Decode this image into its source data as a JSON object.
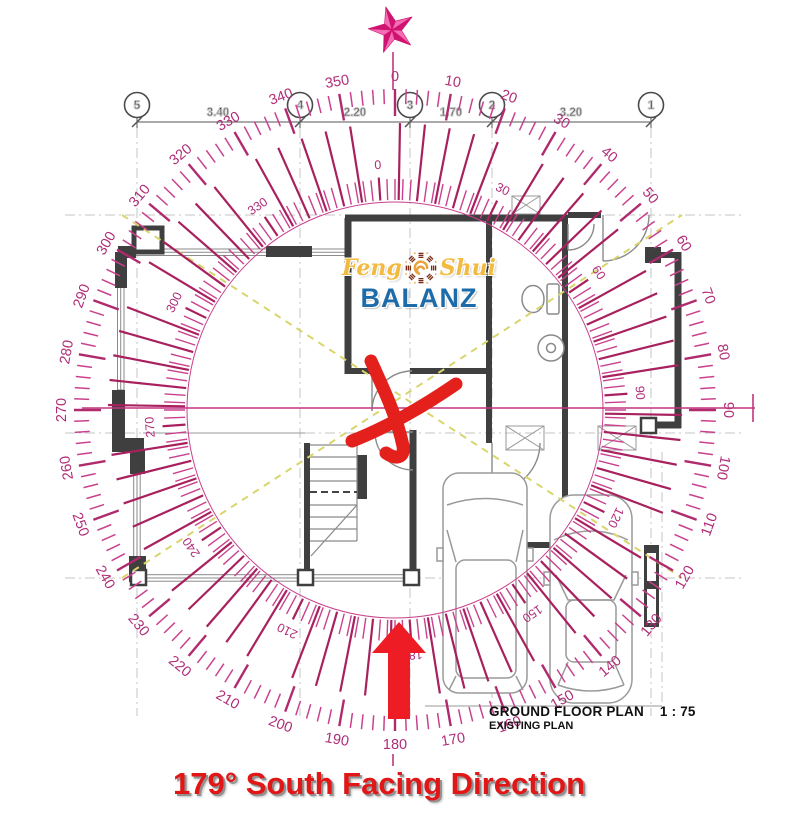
{
  "title": {
    "text": "179° South Facing Direction",
    "color": "#e11717"
  },
  "plan_label": {
    "name": "GROUND FLOOR PLAN",
    "scale": "1 : 75",
    "sub": "EXISTING PLAN"
  },
  "logo": {
    "script_left": "Feng",
    "script_right": "Shui",
    "main": "BALANZ",
    "script_color": "#f2ba3e",
    "main_color": "#1d6ca9",
    "bagua_icon": "bagua-icon"
  },
  "grid": {
    "bubble_y": 105,
    "dim_y": 116,
    "bubbles": [
      {
        "label": "5",
        "x": 137
      },
      {
        "label": "4",
        "x": 300
      },
      {
        "label": "3",
        "x": 410
      },
      {
        "label": "2",
        "x": 492
      },
      {
        "label": "1",
        "x": 651
      }
    ],
    "dims": [
      {
        "label": "3.40",
        "x": 218
      },
      {
        "label": "2.20",
        "x": 355
      },
      {
        "label": "1.70",
        "x": 451
      },
      {
        "label": "3.20",
        "x": 571
      }
    ]
  },
  "compass": {
    "center_x": 395,
    "center_y": 410,
    "inner_offset_deg": -4,
    "outer_labels": [
      0,
      10,
      20,
      30,
      40,
      50,
      60,
      70,
      80,
      90,
      100,
      110,
      120,
      130,
      140,
      150,
      160,
      170,
      180,
      190,
      200,
      210,
      220,
      230,
      240,
      250,
      260,
      270,
      280,
      290,
      300,
      310,
      320,
      330,
      340,
      350
    ],
    "inner_labels": [
      0,
      30,
      60,
      90,
      120,
      150,
      180,
      210,
      240,
      270,
      300,
      330
    ],
    "colors": {
      "tick_minor": "#c9418e",
      "tick_major": "#b02a6e",
      "tick_long": "#a8215e",
      "label": "#b02d78",
      "crosshair": "#c2357f",
      "star_light": "#f46cb4",
      "star_dark": "#cf1370",
      "mark_red": "#e3201b",
      "arrow_red": "#ee1c24"
    }
  }
}
